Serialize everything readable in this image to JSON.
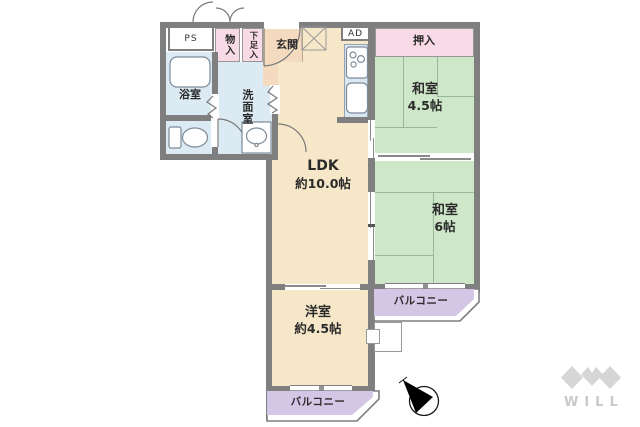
{
  "floorplan": {
    "colors": {
      "wall": "#7f7f7f",
      "wood": "#f7e7c9",
      "entrance": "#f4dbc0",
      "tatami": "#cfe7c9",
      "tatami_line": "#96b898",
      "water": "#dceaf3",
      "closet": "#f8d9e6",
      "balcony": "#d4c7e5",
      "counter": "#dce8f1",
      "line": "#7a7a7a",
      "text": "#2b2b2b",
      "logo": "#d6d6d6",
      "logo_text": "#c9c9c9"
    },
    "labels": {
      "ps": "PS",
      "ad": "AD",
      "storage": "物入",
      "shoe_box": "下足入",
      "entrance": "玄関",
      "bathroom": "浴室",
      "washroom": "洗面室",
      "closet": "押入",
      "balcony_right": "バルコニー",
      "balcony_bottom": "バルコニー"
    },
    "rooms": {
      "japanese_room_small": {
        "name": "和室",
        "size": "4.5帖"
      },
      "japanese_room_large": {
        "name": "和室",
        "size": "6帖"
      },
      "ldk": {
        "name": "LDK",
        "size": "約10.0帖"
      },
      "western_room": {
        "name": "洋室",
        "size": "約4.5帖"
      }
    },
    "logo": {
      "text": "WILL"
    }
  }
}
